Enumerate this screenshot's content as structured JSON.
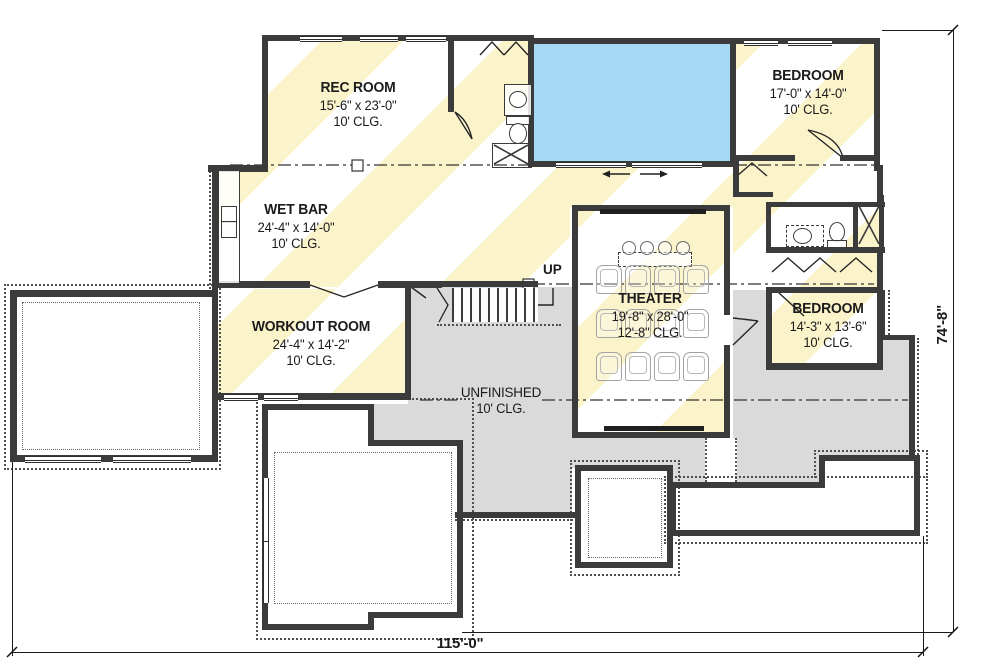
{
  "rooms": {
    "rec_room": {
      "name": "REC ROOM",
      "size": "15'-6\" x 23'-0\"",
      "ceiling": "10' CLG."
    },
    "bedroom_top": {
      "name": "BEDROOM",
      "size": "17'-0\" x 14'-0\"",
      "ceiling": "10' CLG."
    },
    "wet_bar": {
      "name": "WET BAR",
      "size": "24'-4\" x 14'-0\"",
      "ceiling": "10' CLG."
    },
    "workout_room": {
      "name": "WORKOUT ROOM",
      "size": "24'-4\" x 14'-2\"",
      "ceiling": "10' CLG."
    },
    "theater": {
      "name": "THEATER",
      "size": "19'-8\" x 28'-0\"",
      "ceiling": "12'-8\" CLG."
    },
    "bedroom_right": {
      "name": "BEDROOM",
      "size": "14'-3\" x 13'-6\"",
      "ceiling": "10' CLG."
    },
    "unfinished": {
      "name": "UNFINISHED",
      "ceiling": "10' CLG."
    }
  },
  "stairs": {
    "label": "UP"
  },
  "dimensions": {
    "overall_width": "115'-0\"",
    "overall_depth": "74'-8\""
  },
  "colors": {
    "pool_water": "#a6d9f3",
    "finished_stripe": "#fbf3c9",
    "unfinished_fill": "#dadada",
    "wall": "#3b3b3b"
  }
}
